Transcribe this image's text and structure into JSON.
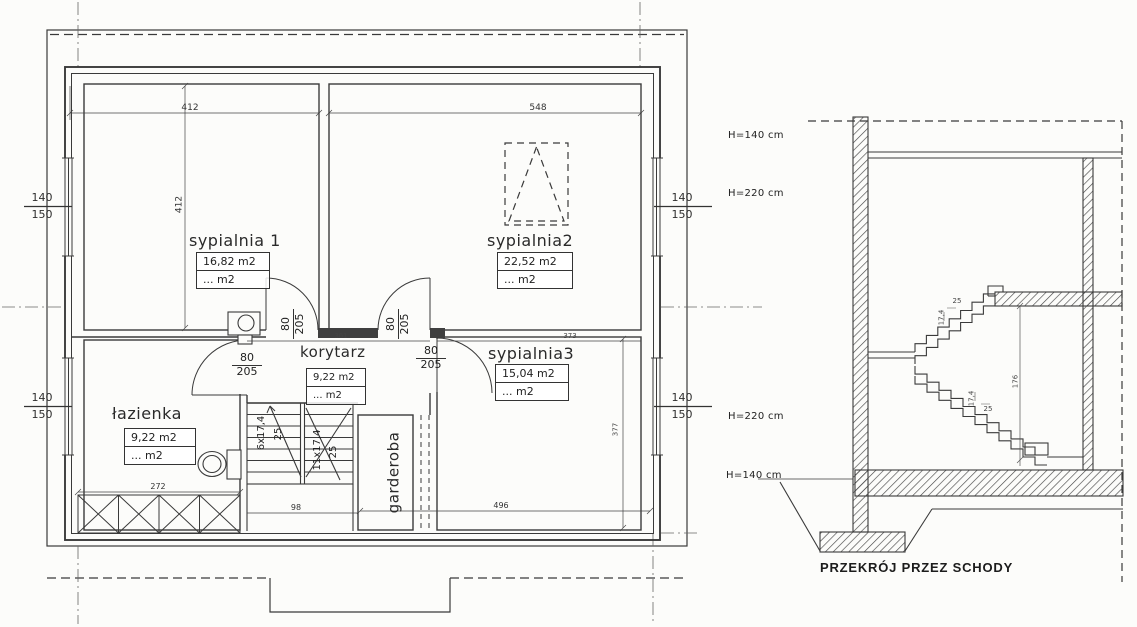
{
  "plan": {
    "rooms": {
      "sypialnia1": {
        "name": "sypialnia 1",
        "area": "16,82 m2",
        "area_alt": "... m2"
      },
      "sypialnia2": {
        "name": "sypialnia2",
        "area": "22,52 m2",
        "area_alt": "... m2"
      },
      "sypialnia3": {
        "name": "sypialnia3",
        "area": "15,04 m2",
        "area_alt": "... m2"
      },
      "korytarz": {
        "name": "korytarz",
        "area": "9,22 m2",
        "area_alt": "... m2"
      },
      "lazienka": {
        "name": "łazienka",
        "area": "9,22 m2",
        "area_alt": "... m2"
      },
      "garderoba": {
        "name": "garderoba"
      }
    },
    "window_dim": {
      "width": "140",
      "sill": "150"
    },
    "door_dim": {
      "width": "80",
      "height": "205"
    },
    "stairs": {
      "flight_a": "6x17,4",
      "run_a": "25",
      "flight_b": "11x17,4",
      "run_b": "25"
    },
    "dims": {
      "top_left": "412",
      "top_right": "548",
      "syp1_depth": "412",
      "korytarz_width": "361",
      "syp3_width": "373",
      "syp3_depth": "377",
      "lazienka_width": "272",
      "stairs_width": "98",
      "bottom_right": "496"
    }
  },
  "section": {
    "title": "PRZEKRÓJ PRZEZ SCHODY",
    "heights": {
      "top_upper": "H=140 cm",
      "top_lower": "H=220 cm",
      "bottom_upper": "H=220 cm",
      "bottom_lower": "H=140 cm"
    },
    "step_dims": {
      "rise": "17,4",
      "run": "25",
      "mid_height": "176"
    }
  },
  "colors": {
    "line": "#3a3a3a",
    "background": "#fcfcfa"
  }
}
